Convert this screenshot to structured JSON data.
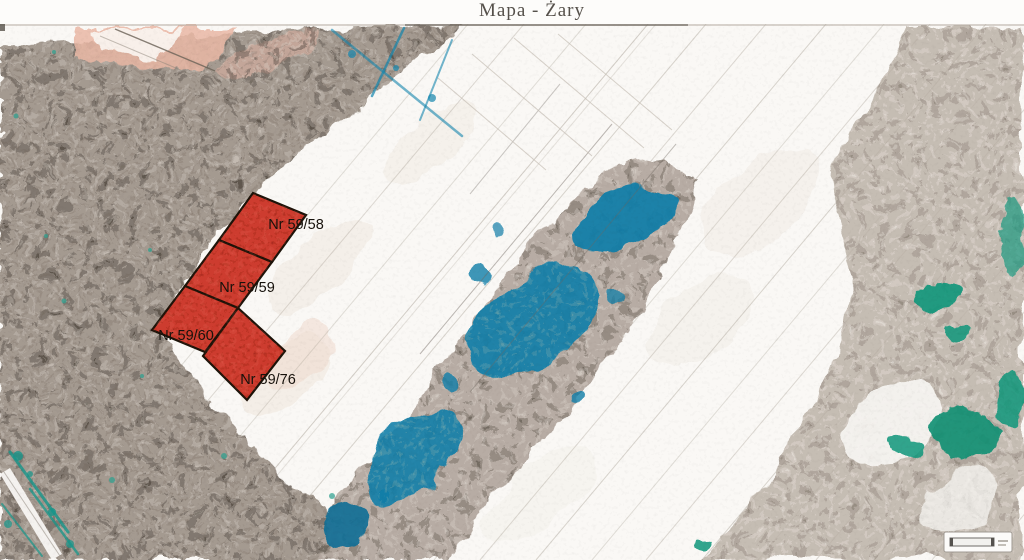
{
  "title": "Mapa - Żary",
  "map": {
    "parcels": [
      {
        "id": "59-58",
        "label": "Nr 59/58",
        "points": "253,169 306,191 272,238 219,216",
        "label_x": 296,
        "label_y": 205
      },
      {
        "id": "59-59",
        "label": "Nr 59/59",
        "points": "219,216 272,238 238,284 185,262",
        "label_x": 247,
        "label_y": 268
      },
      {
        "id": "59-60",
        "label": "Nr 59/60",
        "points": "185,262 238,284 205,328 152,306",
        "label_x": 186,
        "label_y": 316
      },
      {
        "id": "59-76",
        "label": "Nr 59/76",
        "points": "238,284 285,327 247,376 203,332",
        "label_x": 268,
        "label_y": 360
      }
    ],
    "colors": {
      "parcel_fill": "#c92d1f",
      "parcel_border": "#1d1309",
      "parcel_dark_texture": "#7c120c",
      "parcel_light_texture": "#ff8a76",
      "label_color": "#17120c",
      "water_teal": "#0d7da8",
      "vegetation_green": "#12967a",
      "forest_gray": "#a49a90"
    }
  }
}
